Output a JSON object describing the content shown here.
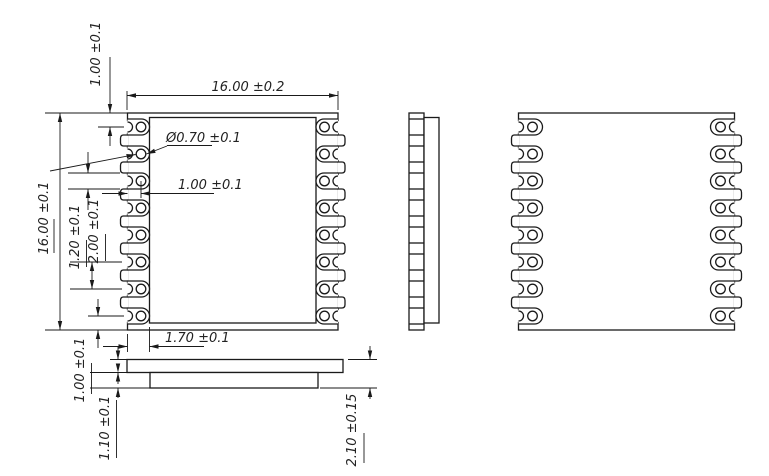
{
  "drawing": {
    "title": "module-package-mechanical-drawing",
    "dimensions": {
      "body_width": "16.00 ±0.2",
      "body_height": "16.00 ±0.1",
      "pin1_edge_offset": "1.00 ±0.1",
      "hole_diameter": "Ø0.70 ±0.1",
      "hole_edge_offset": "1.00 ±0.1",
      "pad_width": "1.20 ±0.1",
      "pin_pitch": "2.00 ±0.1",
      "shield_edge_inset": "1.70 ±0.1",
      "pcb_thickness": "1.00 ±0.1",
      "shield_height": "1.10 ±0.1",
      "total_thickness": "2.10 ±0.15"
    },
    "views": {
      "front": {
        "name": "front-view",
        "pins_per_side": 8
      },
      "side": {
        "name": "side-view"
      },
      "back": {
        "name": "back-view",
        "pins_per_side": 8
      },
      "profile": {
        "name": "bottom-profile-view"
      }
    },
    "colors": {
      "line": "#1a1a1a",
      "background": "#ffffff"
    }
  }
}
